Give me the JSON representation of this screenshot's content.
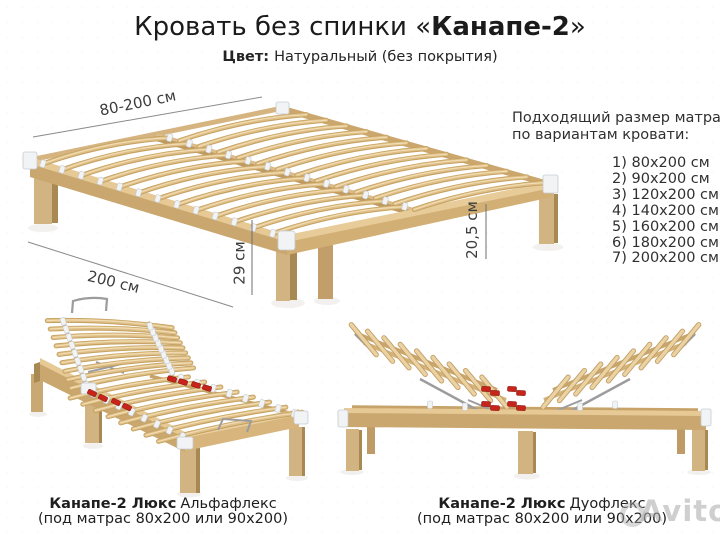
{
  "header": {
    "title_prefix": "Кровать без спинки «",
    "title_name": "Канапе-2",
    "title_suffix": "»",
    "color_label": "Цвет:",
    "color_value": "Натуральный (без покрытия)"
  },
  "dimensions": {
    "width_range": "80-200 см",
    "length": "200 см",
    "height": "29 см",
    "clearance": "20,5 см"
  },
  "mattress_panel": {
    "heading_line1": "Подходящий размер матраса",
    "heading_line2": "по вариантам кровати:",
    "items": [
      "1) 80x200 см",
      "2) 90x200 см",
      "3) 120x200 см",
      "4) 140x200 см",
      "5) 160x200 см",
      "6) 180x200 см",
      "7) 200x200 см"
    ]
  },
  "variants": {
    "alpha": {
      "name": "Канапе-2 Люкс",
      "flex": "Альфафлекс",
      "mattress_note": "(под матрас 80x200 или 90x200)"
    },
    "duo": {
      "name": "Канапе-2 Люкс",
      "flex": "Дуофлекс",
      "mattress_note": "(под матрас 80x200 или 90x200)"
    }
  },
  "watermark": {
    "text": "Avito"
  },
  "colors": {
    "wood_top": "#e6c994",
    "wood_face": "#c9a76f",
    "wood_dark": "#a98953",
    "slat": "#e0c08a",
    "slat_dark": "#c5a261",
    "slat_hi": "#f2deb3",
    "leg": "#d2b382",
    "rail_line": "#c7a369",
    "cap": "#f1f3f5",
    "cap_border": "#c6cbd1",
    "red": "#c8241b",
    "metal": "#9c9c9f",
    "dim_line": "#8a8a8a"
  }
}
